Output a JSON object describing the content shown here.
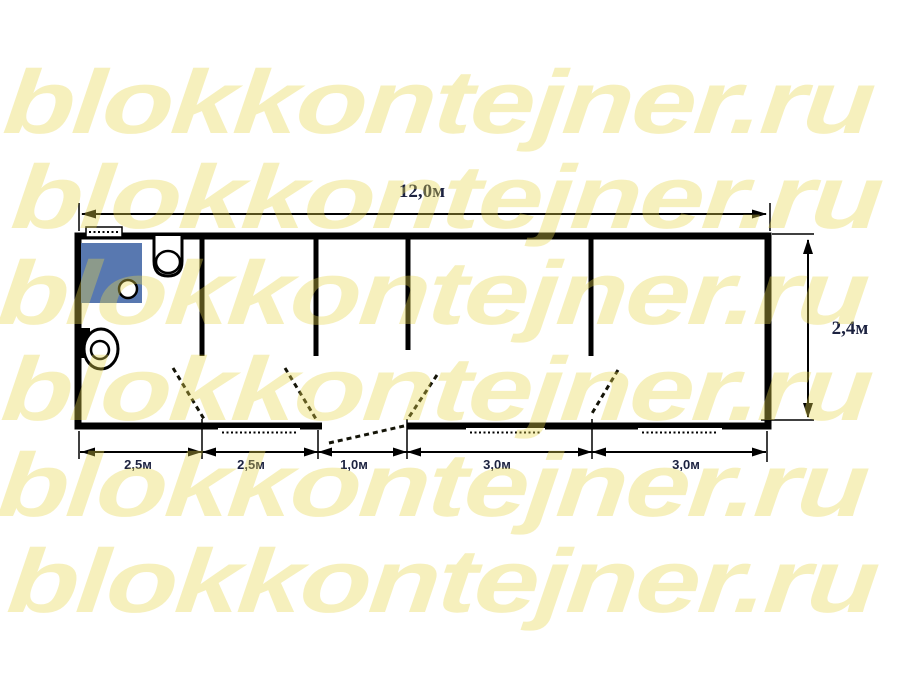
{
  "watermark": {
    "text": "blokkontejner.ru",
    "rows": 6
  },
  "colors": {
    "watermark_rgba": "rgba(230,215,75,0.37)",
    "watermark_hex": "#F6F1BE",
    "shower": "#5878B0",
    "line": "#000000",
    "dim_text": "#1C2240"
  },
  "plan": {
    "type": "floor-plan",
    "dimensions": {
      "total_length": "12,0м",
      "height": "2,4м",
      "segments": [
        "2,5м",
        "2,5м",
        "1,0м",
        "3,0м",
        "3,0м"
      ]
    },
    "rooms_count": 5,
    "doors_count": 5,
    "windows_count": 4,
    "fixtures": [
      "shower-tray",
      "wash-basin",
      "toilet"
    ]
  }
}
